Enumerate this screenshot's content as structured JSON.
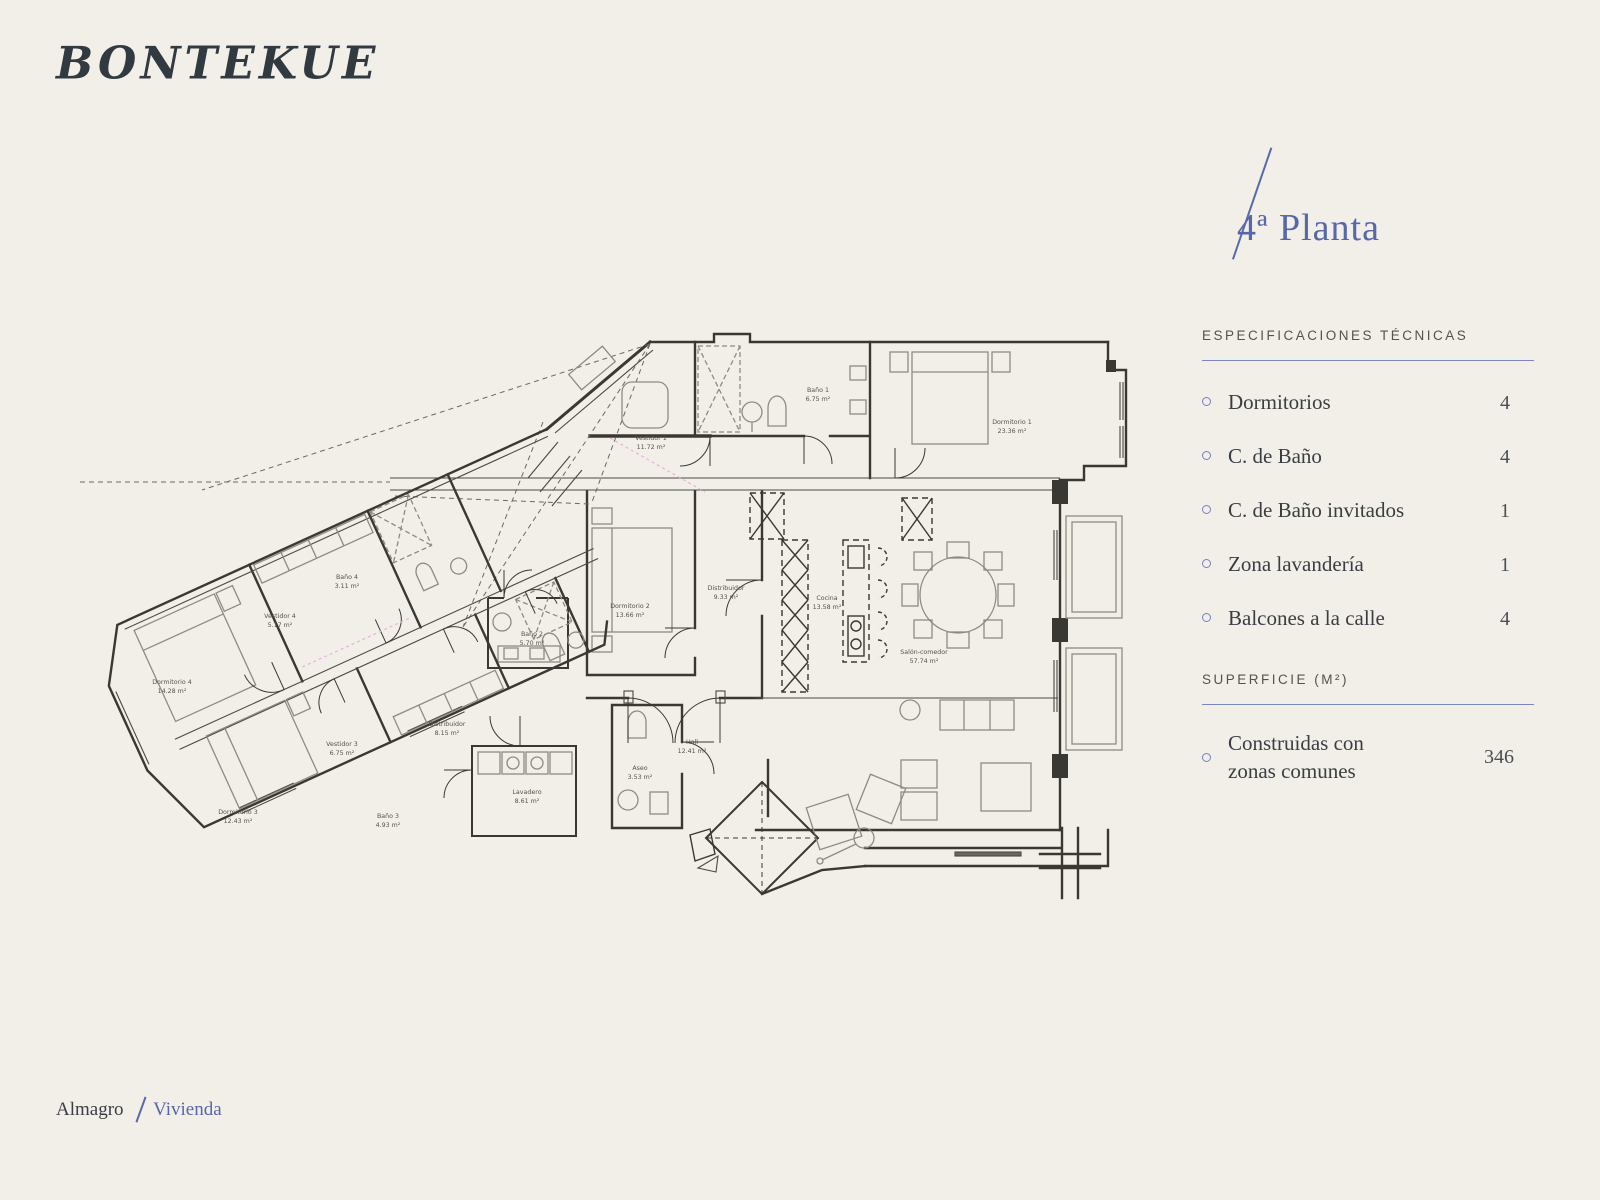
{
  "brand": {
    "logo": "BONTEKUE"
  },
  "header": {
    "title": "4ª Planta"
  },
  "specs": {
    "heading": "ESPECIFICACIONES TÉCNICAS",
    "items": [
      {
        "label": "Dormitorios",
        "value": "4"
      },
      {
        "label": "C. de Baño",
        "value": "4"
      },
      {
        "label": "C. de Baño invitados",
        "value": "1"
      },
      {
        "label": "Zona lavandería",
        "value": "1"
      },
      {
        "label": "Balcones a la calle",
        "value": "4"
      }
    ]
  },
  "surface": {
    "heading": "SUPERFICIE (M²)",
    "item": {
      "label_line1": "Construidas con",
      "label_line2": "zonas comunes",
      "value": "346"
    }
  },
  "footer": {
    "location": "Almagro",
    "category": "Vivienda"
  },
  "colors": {
    "background": "#f2efe9",
    "accent_blue": "#5a69a9",
    "ink": "#323a41",
    "plan_line": "#3a3833",
    "plan_pink": "#e7b0dd"
  },
  "floorplan": {
    "rooms": [
      {
        "name": "Vestidor 1",
        "area": "11.72 m²"
      },
      {
        "name": "Baño 1",
        "area": "6.75 m²"
      },
      {
        "name": "Dormitorio 1",
        "area": "23.36 m²"
      },
      {
        "name": "Dormitorio 2",
        "area": "13.66 m²"
      },
      {
        "name": "Distribuidor",
        "area": "9.33 m²"
      },
      {
        "name": "Cocina",
        "area": "13.58 m²"
      },
      {
        "name": "Salón-comedor",
        "area": "57.74 m²"
      },
      {
        "name": "Hall",
        "area": "12.41 m²"
      },
      {
        "name": "Aseo",
        "area": "3.53 m²"
      },
      {
        "name": "Baño 2",
        "area": "5.70 m²"
      },
      {
        "name": "Distribuidor",
        "area": "8.15 m²"
      },
      {
        "name": "Lavadero",
        "area": "8.61 m²"
      },
      {
        "name": "Vestidor 3",
        "area": "6.75 m²"
      },
      {
        "name": "Baño 3",
        "area": "4.93 m²"
      },
      {
        "name": "Dormitorio 3",
        "area": "12.43 m²"
      },
      {
        "name": "Vestidor 4",
        "area": "5.17 m²"
      },
      {
        "name": "Baño 4",
        "area": "3.11 m²"
      },
      {
        "name": "Dormitorio 4",
        "area": "14.28 m²"
      }
    ]
  }
}
